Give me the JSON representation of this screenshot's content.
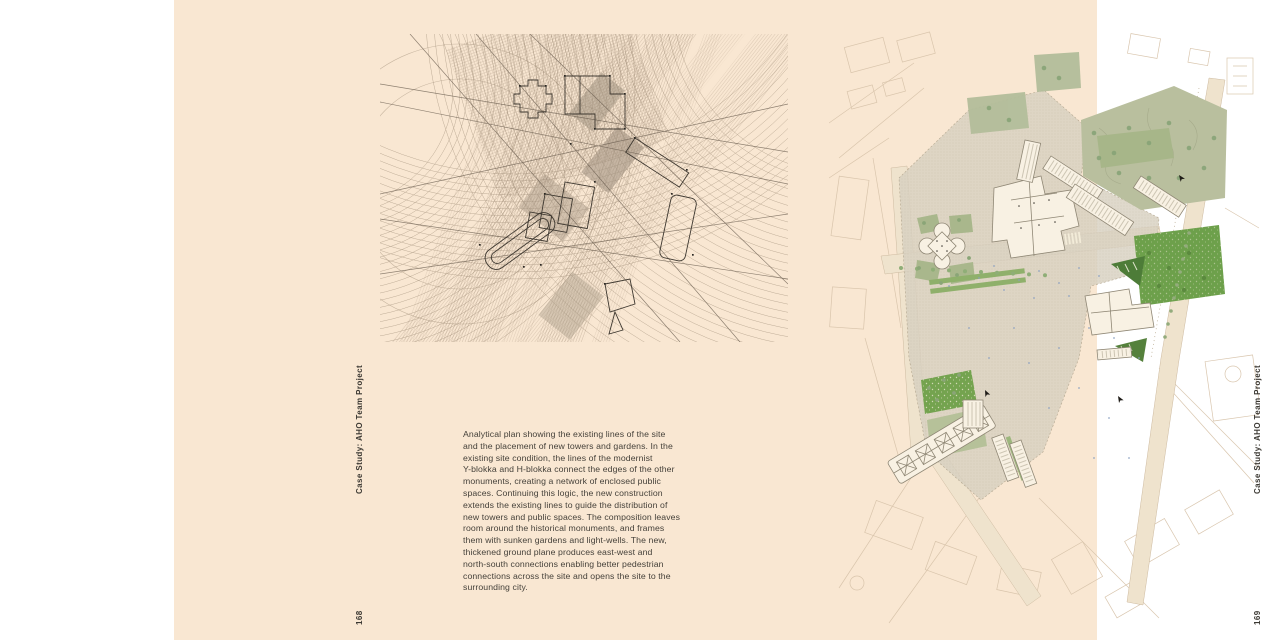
{
  "spread": {
    "colors": {
      "paper": "#f9e7d2",
      "ink": "#3c3933",
      "drawing_line_brown": "#8d7b65",
      "plan_paving_gray": "#d8d1c1",
      "plan_park_olive": "#b9bf9e",
      "plan_lawn_green": "#6da04b",
      "plan_sunken_garden_green": "#4d7c38",
      "plan_tree_green": "#87a377",
      "plan_faint_outline": "#d7c3aa"
    },
    "left_page": {
      "side_label": "Case Study: AHO Team Project",
      "page_number": "168",
      "caption_lines": [
        "Analytical plan showing the existing lines of the site",
        "and the placement of new towers and gardens. In the",
        "existing site condition, the lines of the modernist",
        "Y-blokka and H-blokka connect the edges of the other",
        "monuments, creating a network of enclosed public",
        "spaces. Continuing this logic, the new construction",
        "extends the existing lines to guide the distribution of",
        "new towers and public spaces. The composition leaves",
        "room around the historical monuments, and frames",
        "them with sunken gardens and light-wells. The new,",
        "thickened ground plane produces east-west and",
        "north-south connections enabling better pedestrian",
        "connections across the site and opens the site to the",
        "surrounding city."
      ]
    },
    "right_page": {
      "side_label": "Case Study: AHO Team Project",
      "page_number": "169"
    }
  }
}
